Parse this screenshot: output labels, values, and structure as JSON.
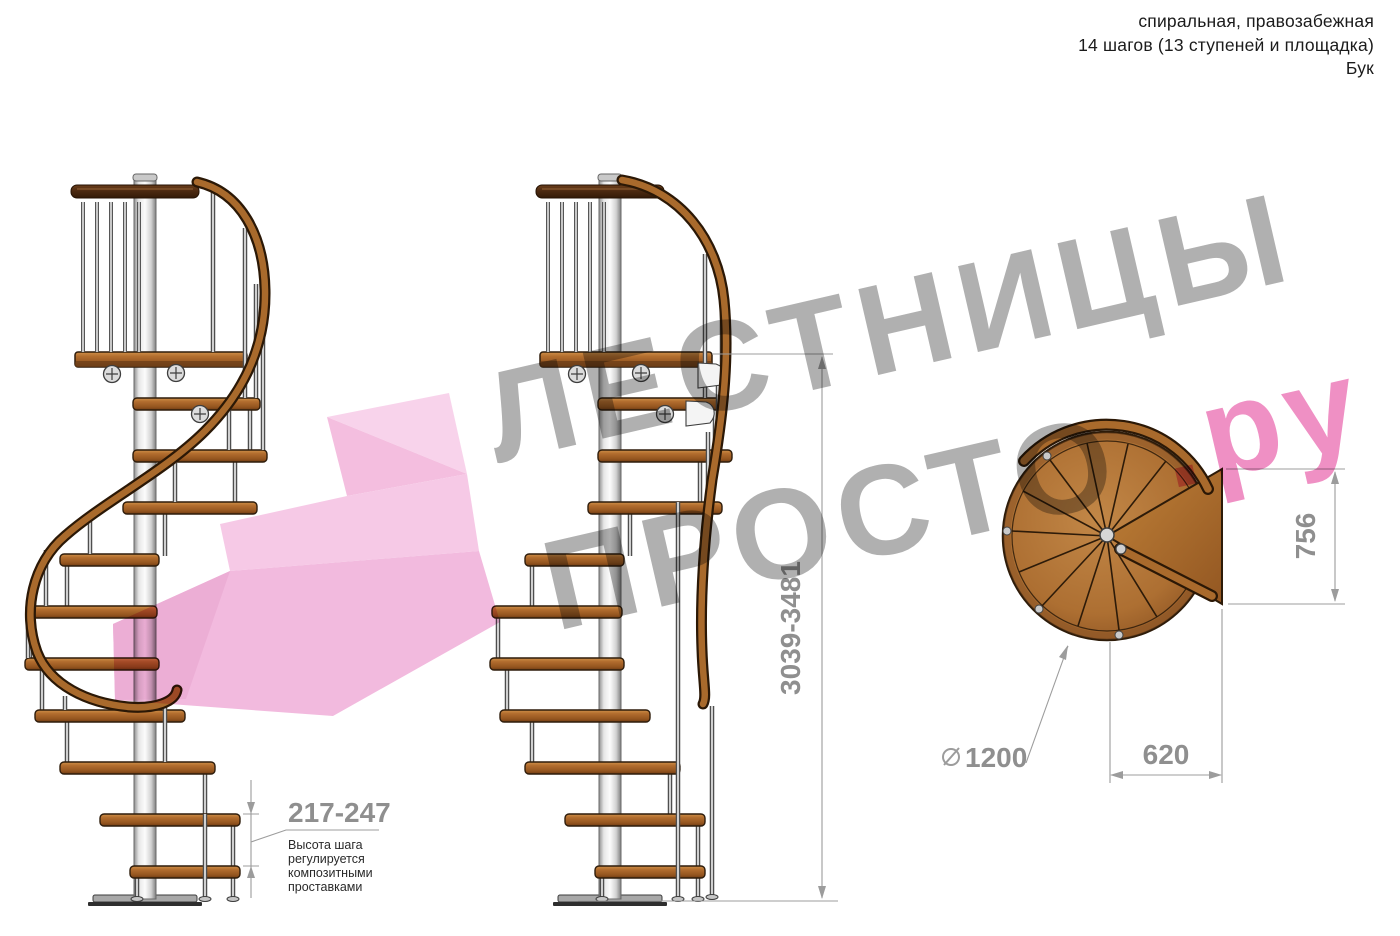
{
  "header": {
    "line1": "спиральная, правозабежная",
    "line2": "14 шагов (13 ступеней и площадка)",
    "line3": "Бук"
  },
  "watermark": {
    "word1": "ЛЕСТНИЦЫ",
    "word2": "ПРОСТО",
    "word2_suffix": ".ру"
  },
  "dimensions": {
    "total_height": "3039-3481",
    "step_height": "217-247",
    "step_height_note_line1": "Высота шага",
    "step_height_note_line2": "регулируется",
    "step_height_note_line3": "композитными",
    "step_height_note_line4": "проставками",
    "diameter": "1200",
    "landing_depth": "756",
    "step_width": "620"
  },
  "colors": {
    "watermark_gray": "#a9a9a9",
    "watermark_pink": "#ee87bf",
    "dimension_text": "#8f8f8f",
    "wood": "#b26d2e",
    "arrow_pink": "#f2b5db"
  }
}
